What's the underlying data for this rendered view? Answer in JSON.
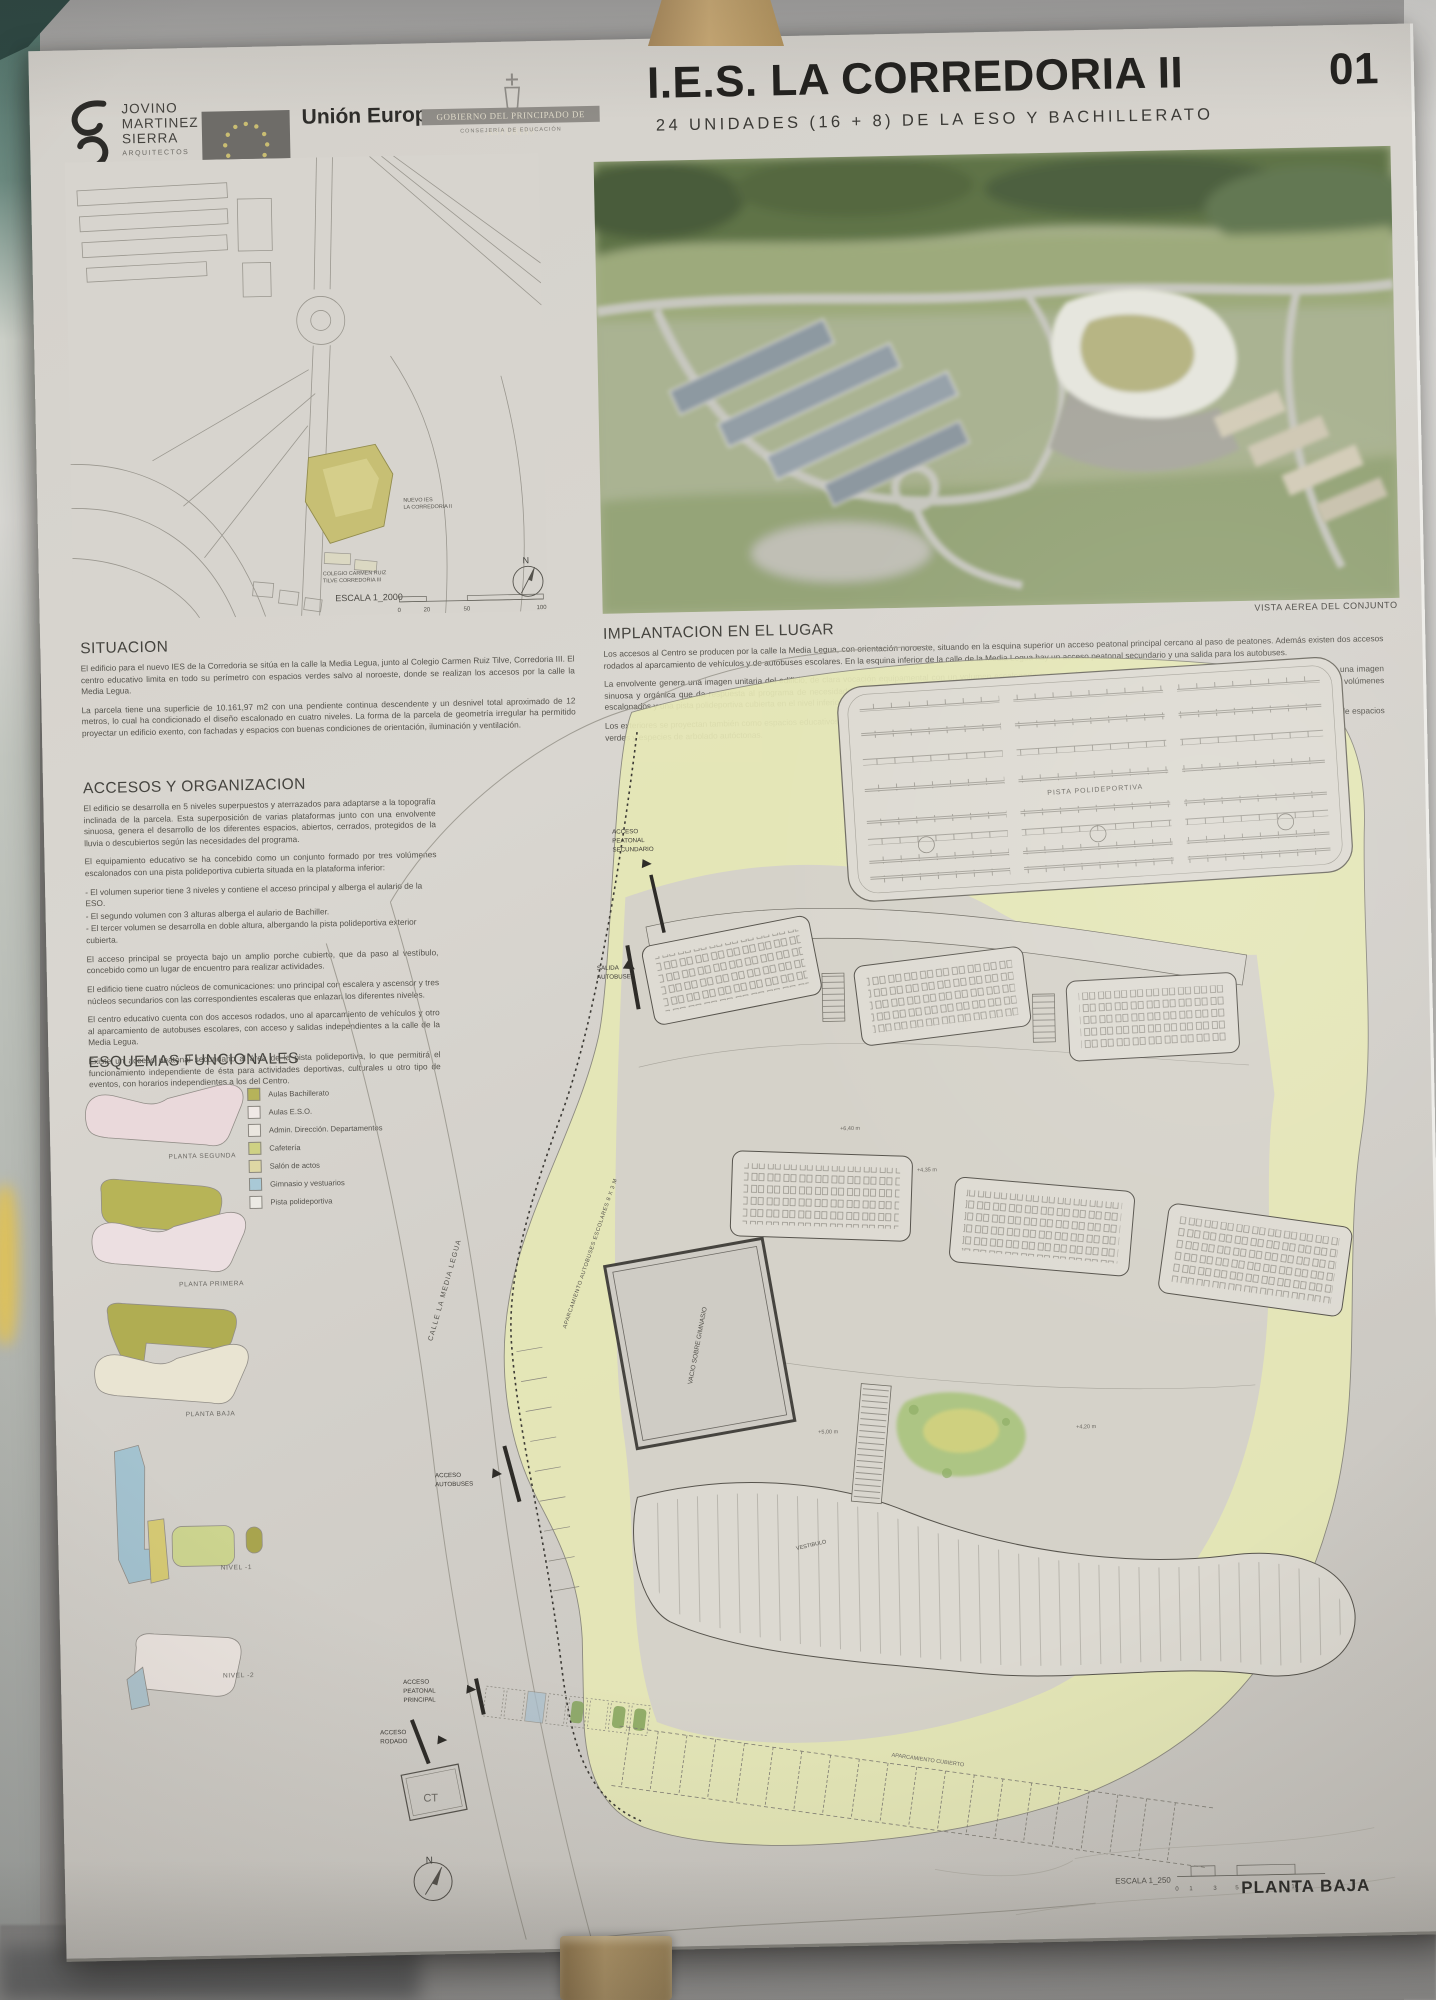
{
  "header": {
    "architect": {
      "lines": [
        "JOVINO",
        "MARTINEZ",
        "SIERRA"
      ],
      "subtitle": "ARQUITECTOS"
    },
    "eu": {
      "title": "Unión Europea",
      "subtitle_line1": "Fondo Europeo",
      "subtitle_line2": "de Desarrollo Regional"
    },
    "asturias": {
      "band": "GOBIERNO DEL PRINCIPADO DE ASTURIAS",
      "subtitle": "CONSEJERÍA DE EDUCACIÓN"
    },
    "title": "I.E.S. LA CORREDORIA II",
    "sheet_number": "01",
    "subtitle": "24 UNIDADES (16 + 8) DE LA ESO Y BACHILLERATO"
  },
  "site_map": {
    "labels": {
      "nuevo_line1": "NUEVO IES",
      "nuevo_line2": "LA CORREDORIA II",
      "colegio_line1": "COLEGIO CARMEN RUIZ",
      "colegio_line2": "TILVE CORREDORIA III"
    },
    "escala": "ESCALA 1_2000",
    "ticks": [
      "0",
      "20",
      "50",
      "100"
    ],
    "north": "N"
  },
  "aerial": {
    "caption": "VISTA AEREA DEL CONJUNTO"
  },
  "situacion": {
    "heading": "SITUACION",
    "paragraphs": [
      "El edificio para el nuevo IES de la Corredoria se sitúa en la calle la Media Legua, junto al Colegio Carmen Ruiz Tilve, Corredoria III. El centro educativo limita en todo su perímetro con espacios verdes salvo al noroeste, donde se realizan los accesos por la calle la Media Legua.",
      "La parcela tiene una superficie de 10.161,97 m2 con una pendiente continua descendente y un desnivel total aproximado de 12 metros, lo cual ha condicionado el diseño escalonado en cuatro niveles. La forma de la parcela de geometría irregular ha permitido proyectar un edificio exento, con fachadas y espacios con buenas condiciones de orientación, iluminación y ventilación."
    ]
  },
  "implantacion": {
    "heading": "IMPLANTACION EN EL LUGAR",
    "paragraphs": [
      "Los accesos al Centro se producen por la calle la Media Legua, con orientación noroeste, situando en la esquina superior un acceso peatonal principal cercano al paso de peatones. Además existen dos accesos rodados al aparcamiento de vehículos y de autobuses escolares. En la esquina inferior de la calle de la Media Legua hay un acceso peatonal secundario y una salida para los autobuses.",
      "La envolvente genera una imagen unitaria del edificio, de clara vocación equipamental con un volumen escalonado que se adapta al terreno generando el mínimo impacto urbano. El edificio tiene una imagen sinuosa y orgánica que da respuesta al programa de necesidades, creando una arquitectura sugerente mediante el movimiento y el color de las fachadas, creando un conjunto formado por tres volúmenes escalonados y una pista polideportiva cubierta en el nivel inferior.",
      "Los exteriores se proyectan también como espacios educativos al aire libre, posibilitando una gestión dinámica del recreo y de las clases o actos al aire libre, creando un entorno estimulador rodeado de espacios verdes y especies de arbolado autóctonas."
    ]
  },
  "accesos": {
    "heading": "ACCESOS Y ORGANIZACION",
    "paragraphs": [
      "El edificio se desarrolla en 5 niveles superpuestos y aterrazados para adaptarse a la topografía inclinada de la parcela. Esta superposición de varias plataformas junto con una envolvente sinuosa, genera el desarrollo de los diferentes espacios, abiertos, cerrados, protegidos de la lluvia o descubiertos según las necesidades del programa.",
      "El equipamiento educativo se ha concebido como un conjunto formado por tres volúmenes escalonados con una pista polideportiva cubierta situada en la plataforma inferior:"
    ],
    "bullets": [
      "- El volumen superior tiene 3 niveles y contiene el acceso principal y alberga el aulario de la ESO.",
      "- El segundo volumen con 3 alturas alberga el aulario de Bachiller.",
      "- El tercer volumen se desarrolla en doble altura, albergando la pista polideportiva exterior cubierta."
    ],
    "paragraphs2": [
      "El acceso principal se proyecta bajo un amplio porche cubierto, que da paso al vestíbulo, concebido como un lugar de encuentro para realizar actividades.",
      "El edificio tiene cuatro núcleos de comunicaciones: uno principal con escalera y ascensor y tres núcleos secundarios con las correspondientes escaleras que enlazan los diferentes niveles.",
      "El centro educativo cuenta con dos accesos rodados, uno al aparcamiento de vehículos y otro al aparcamiento de autobuses escolares, con acceso y salidas independientes a la calle de la Media Legua.",
      "Existe un acceso peatonal secundario al área de la pista polideportiva, lo que permitirá el funcionamiento independiente de ésta para actividades deportivas, culturales u otro tipo de eventos, con horarios independientes a los del Centro."
    ]
  },
  "esquemas": {
    "heading": "ESQUEMAS FUNCIONALES",
    "legend": [
      {
        "label": "Aulas Bachillerato",
        "color": "#b6b35a"
      },
      {
        "label": "Aulas E.S.O.",
        "color": "#f0e9e6"
      },
      {
        "label": "Admin. Dirección. Departamentos",
        "color": "#eae6df"
      },
      {
        "label": "Cafetería",
        "color": "#ced183"
      },
      {
        "label": "Salón de actos",
        "color": "#ded7a4"
      },
      {
        "label": "Gimnasio y vestuarios",
        "color": "#a9c9d6"
      },
      {
        "label": "Pista polideportiva",
        "color": "#eceae4"
      }
    ],
    "levels": [
      "PLANTA SEGUNDA",
      "PLANTA PRIMERA",
      "PLANTA BAJA",
      "NIVEL -1",
      "NIVEL -2"
    ]
  },
  "plan": {
    "labels": {
      "aps_lines": [
        "ACCESO",
        "PEATONAL",
        "SECUNDARIO"
      ],
      "salida_lines": [
        "SALIDA",
        "AUTOBUSES"
      ],
      "aa_lines": [
        "ACCESO",
        "AUTOBUSES"
      ],
      "app_lines": [
        "ACCESO",
        "PEATONAL",
        "PRINCIPAL"
      ],
      "ar_lines": [
        "ACCESO",
        "RODADO"
      ],
      "calle": "CALLE LA MEDIA LEGUA",
      "aparc_autobuses": "APARCAMIENTO AUTOBUSES ESCOLARES 8 X 3 M",
      "aparc_cubierto": "APARCAMIENTO CUBIERTO",
      "pista": "PISTA POLIDEPORTIVA",
      "gimnasio": "VACIO SOBRE GIMNASIO",
      "vestibulo": "VESTIBULO",
      "ct": "CT",
      "north": "N",
      "niveles": [
        "+6,40 m",
        "+4,35 m",
        "+5,00 m",
        "+4,20 m"
      ]
    },
    "escala": {
      "label": "ESCALA 1_250",
      "ticks": [
        "0",
        "1",
        "3",
        "5",
        "10"
      ]
    },
    "sheet_title": "PLANTA BAJA"
  },
  "palette": {
    "site_highlight": "#c7bf74",
    "plan_green": "#e6e8b6"
  }
}
